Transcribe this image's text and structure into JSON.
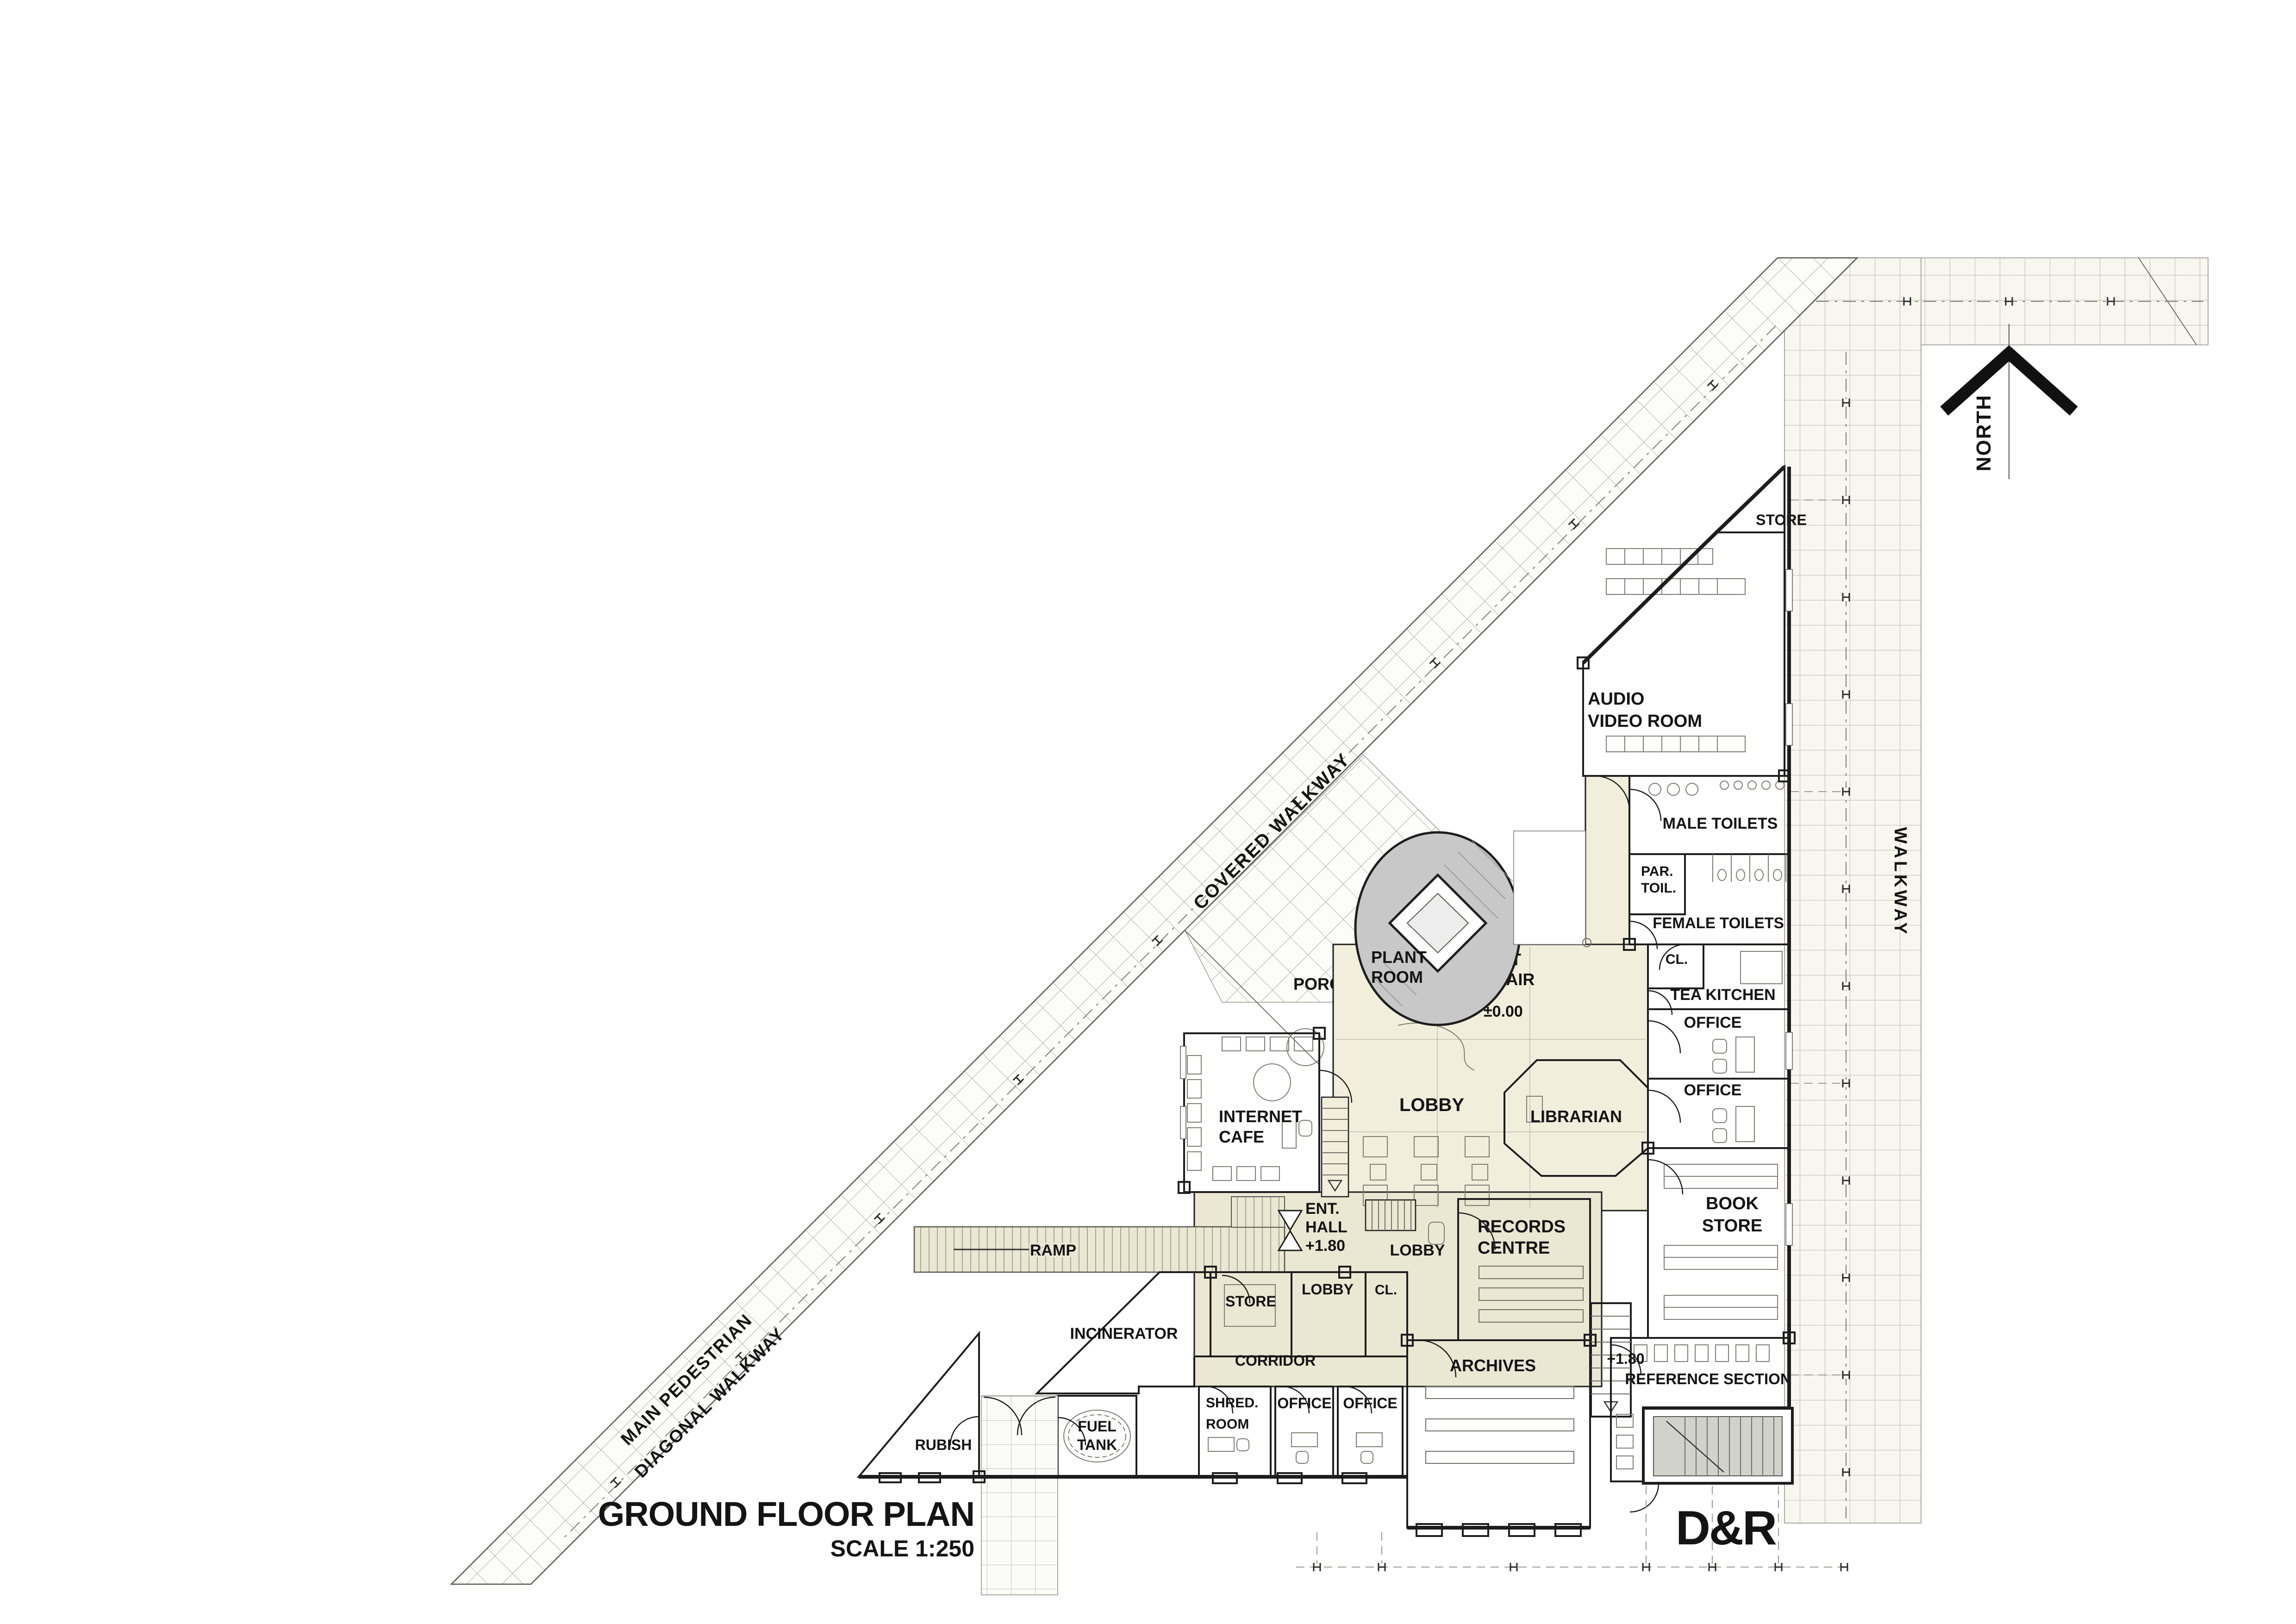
{
  "drawing": {
    "title": "GROUND FLOOR PLAN",
    "scale_label": "SCALE 1:250",
    "logo": "D&R",
    "north_label": "NORTH"
  },
  "site": {
    "covered_walkway": "COVERED WALKWAY",
    "main_pedestrian_1": "MAIN PEDESTRIAN",
    "main_pedestrian_2": "DIAGONAL WALKWAY",
    "side_walkway": "WALKWAY",
    "ramp": "RAMP",
    "porch": "PORCH"
  },
  "levels": {
    "ground": "±0.00",
    "entrance": "+1.80",
    "reference": "+1.80"
  },
  "rooms": {
    "store_top": "STORE",
    "audio_video_1": "AUDIO",
    "audio_video_2": "VIDEO ROOM",
    "male_toilets": "MALE TOILETS",
    "par_toil_1": "PAR.",
    "par_toil_2": "TOIL.",
    "female_toilets": "FEMALE TOILETS",
    "cl_upper": "CL.",
    "tea_kitchen": "TEA KITCHEN",
    "office_1": "OFFICE",
    "office_2": "OFFICE",
    "book_store_1": "BOOK",
    "book_store_2": "STORE",
    "plant_room_1": "PLANT",
    "plant_room_2": "ROOM",
    "lift_stair_1": "LIFT",
    "lift_stair_2": "STAIR",
    "lobby_main": "LOBBY",
    "librarian": "LIBRARIAN",
    "internet_cafe_1": "INTERNET",
    "internet_cafe_2": "CAFE",
    "ent_hall_1": "ENT.",
    "ent_hall_2": "HALL",
    "lobby_mid": "LOBBY",
    "records_1": "RECORDS",
    "records_2": "CENTRE",
    "store_lower": "STORE",
    "lobby_lower": "LOBBY",
    "cl_lower": "CL.",
    "incinerator": "INCINERATOR",
    "corridor": "CORRIDOR",
    "shred_1": "SHRED.",
    "shred_2": "ROOM",
    "office_3": "OFFICE",
    "office_4": "OFFICE",
    "archives": "ARCHIVES",
    "reference_section": "REFERENCE SECTION",
    "rubish": "RUBISH",
    "fuel_1": "FUEL",
    "fuel_2": "TANK"
  },
  "colors": {
    "room_gray": "#c9c8be",
    "room_dark": "#b7b6a9",
    "cream": "#f1efdc",
    "cream_dark": "#eae7d2",
    "plant_gray": "#c8c8c8",
    "paving": "#f7f6ef",
    "wall": "#1d1d1d"
  }
}
